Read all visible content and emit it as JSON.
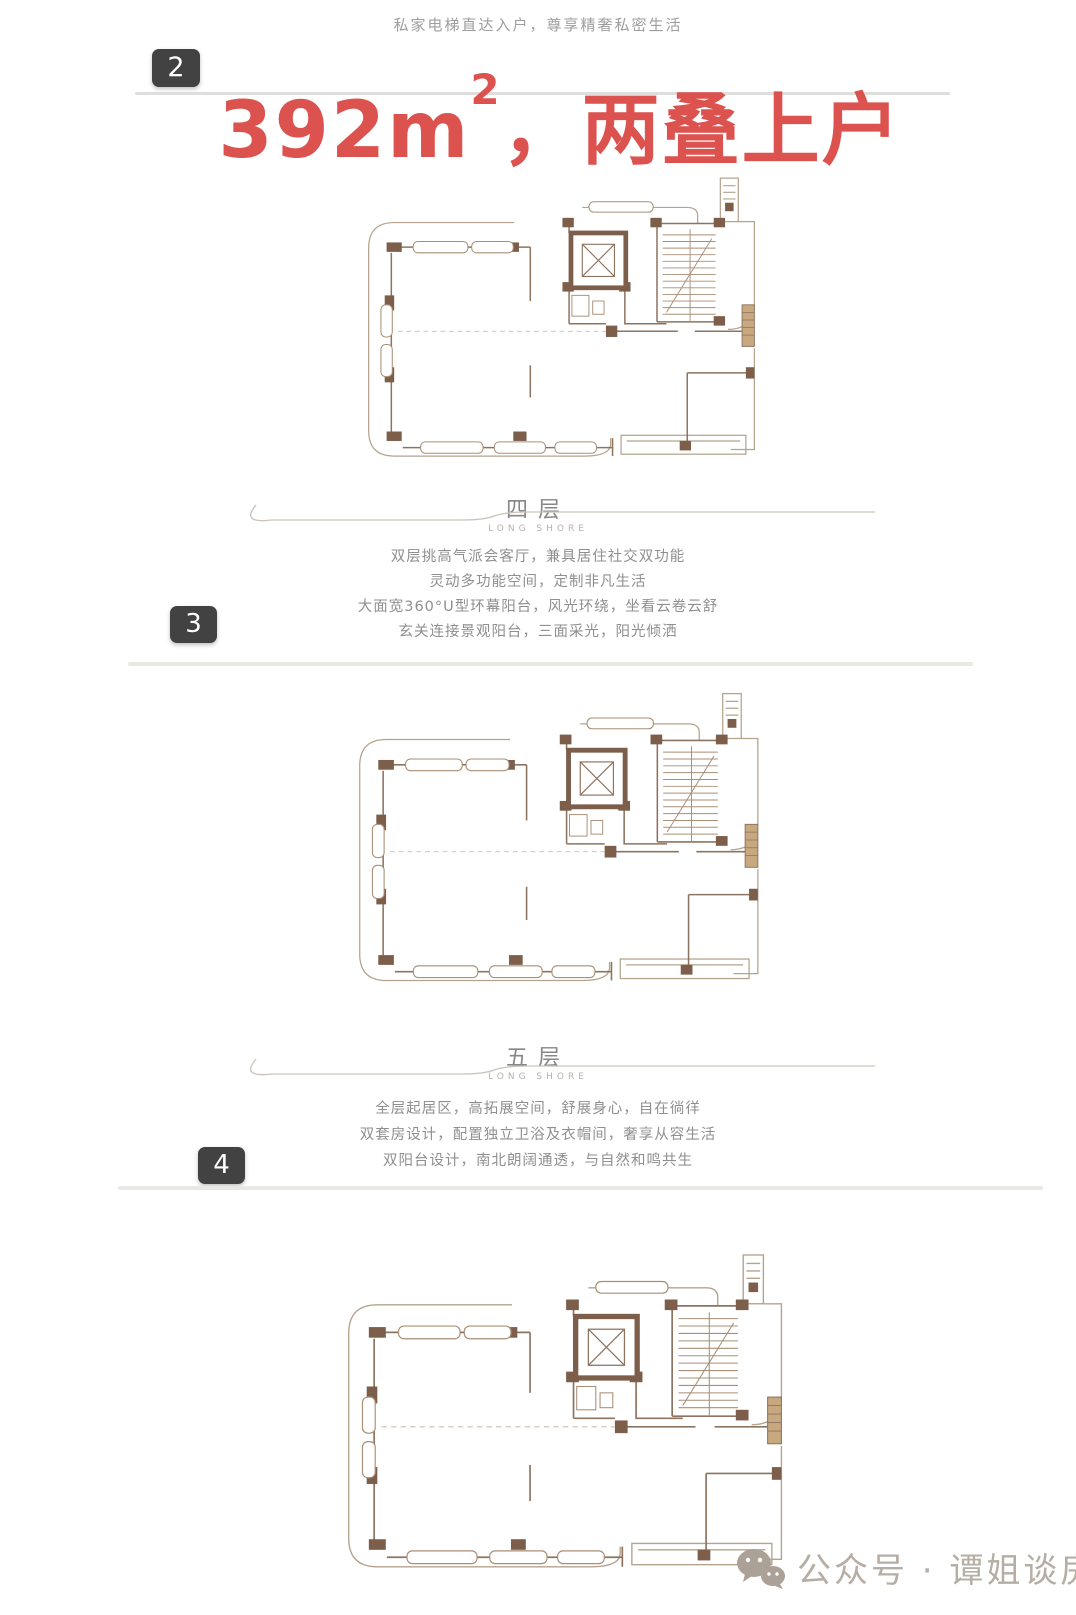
{
  "header": {
    "text": "私家电梯直达入户，尊享精奢私密生活"
  },
  "title": {
    "badge": "2",
    "area": "392m",
    "area_sup": "2",
    "suffix": "，两叠上户",
    "color": "#dc524e"
  },
  "sections": [
    {
      "badge": "3",
      "floor": {
        "label": "四层",
        "subtitle": "LONG SHORE"
      },
      "lines": [
        "双层挑高气派会客厅，兼具居住社交双功能",
        "灵动多功能空间，定制非凡生活",
        "大面宽360°U型环幕阳台，风光环绕，坐看云卷云舒",
        "玄关连接景观阳台，三面采光，阳光倾洒"
      ]
    },
    {
      "badge": "4",
      "floor": {
        "label": "五层",
        "subtitle": "LONG SHORE"
      },
      "lines": [
        "全层起居区，高拓展空间，舒展身心，自在徜徉",
        "双套房设计，配置独立卫浴及衣帽间，奢享从容生活",
        "双阳台设计，南北朗阔通透，与自然和鸣共生"
      ]
    }
  ],
  "plans": [
    {
      "name": "floor-4-plan"
    },
    {
      "name": "floor-5-plan"
    },
    {
      "name": "floor-6-plan"
    }
  ],
  "watermark": {
    "icon": "wechat-icon",
    "text": "公众号 · 谭姐谈房"
  },
  "colors": {
    "accent_red": "#dc524e",
    "badge_bg": "#424242",
    "plan_wall": "#7c5e4b"
  }
}
